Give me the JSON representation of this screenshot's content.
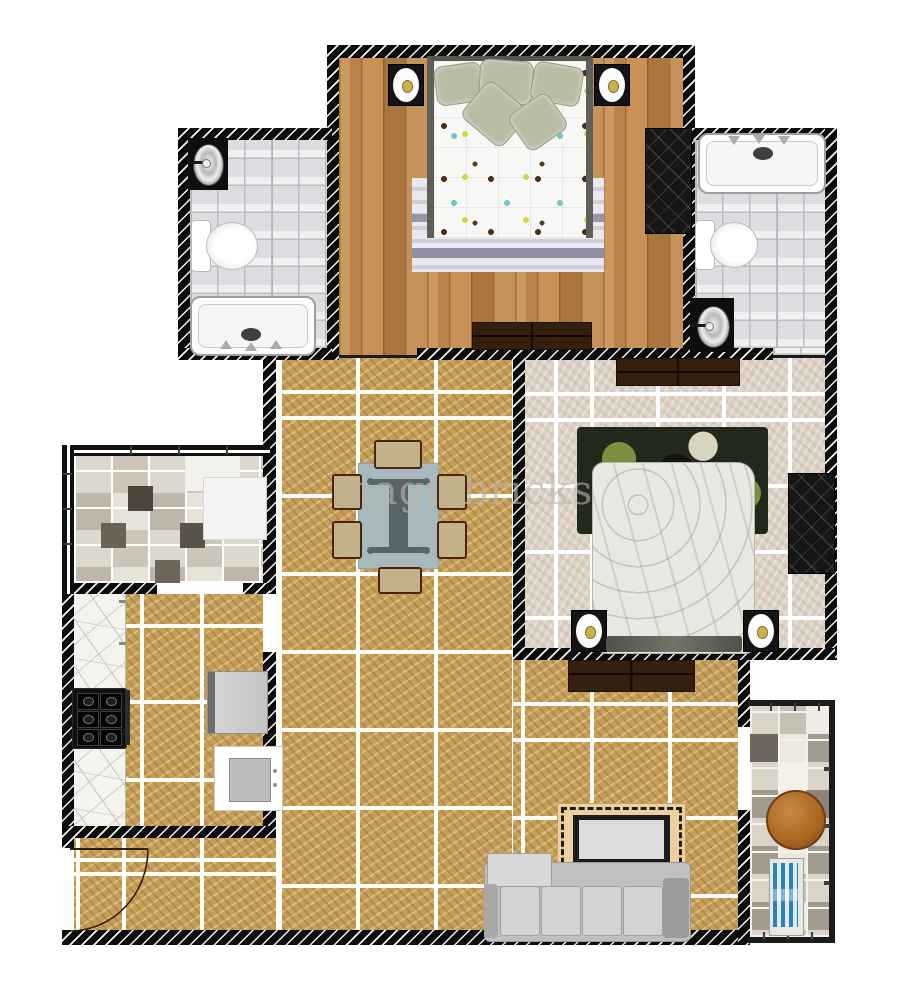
{
  "watermark": {
    "text": "magicbricks"
  },
  "palette": {
    "background": "#ffffff",
    "wall": "#0c0c0c",
    "wall_hatch": "#f2f2f2",
    "wood_floor": "#c08b52",
    "gold_tile": "#c59e58",
    "beige_tile": "#ddd2c5",
    "grey_bath_tile": "#dddde1",
    "grout": "#ffffff",
    "dark_wood_furniture": "#35200f",
    "black_wardrobe": "#161616",
    "sofa_grey": "#c0c0c0",
    "dining_table": "#a8b9bd",
    "dining_chair": "#c3b287",
    "rug_border_tan": "#eecf9f",
    "bedroom2_rug_green": "#7d8f3f",
    "bathtub_white": "#fdfdfd",
    "steel_fixture": "#9a9a9a",
    "sconce_gold": "#c8b44a",
    "balcony_table_brown": "#a9661f",
    "lounge_chair_blue": "#2f7fb8"
  },
  "rooms": [
    {
      "id": "bedroom-1",
      "floor": "wood-planks"
    },
    {
      "id": "bathroom-1",
      "floor": "grey-tile"
    },
    {
      "id": "bathroom-2",
      "floor": "grey-tile"
    },
    {
      "id": "bedroom-2",
      "floor": "beige-stone-tile"
    },
    {
      "id": "dining-area",
      "floor": "gold-marble-tile"
    },
    {
      "id": "living-area",
      "floor": "gold-marble-tile"
    },
    {
      "id": "kitchen",
      "floor": "gold-marble-tile"
    },
    {
      "id": "utility-room",
      "floor": "mosaic-tile"
    },
    {
      "id": "entrance",
      "floor": "gold-marble-tile"
    },
    {
      "id": "balcony",
      "floor": "checker-tile"
    }
  ],
  "fixtures": [
    "double-bed",
    "wall-lamp",
    "wardrobe",
    "dresser",
    "bathtub",
    "toilet",
    "wash-basin",
    "dining-table",
    "dining-chair",
    "stove-hob",
    "refrigerator",
    "kitchen-sink",
    "sofa",
    "greek-key-rug",
    "round-table",
    "lounge-chair",
    "entrance-door"
  ]
}
